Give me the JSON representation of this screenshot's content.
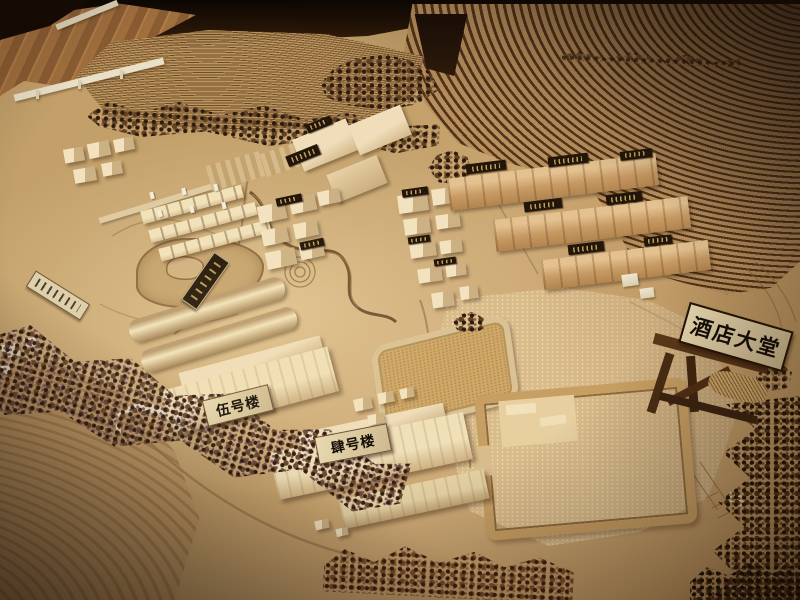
{
  "scene": {
    "type": "photograph",
    "subject": "Wooden architectural scale model of a hillside resort town",
    "setting": "indoor exhibition table under warm lighting, elevated oblique view",
    "features": [
      "laser-cut terraced contour hillsides",
      "clusters of carved wooden buildings and townhouse rows",
      "meandering stream, lake and spiral garden",
      "large plaza with hotel-lobby courtyard footprint",
      "bands of model trees along slopes and edges",
      "engraved wooden name plaques on buildings"
    ]
  },
  "signs": {
    "hotel_lobby": "酒店大堂",
    "building_no5": "伍号楼",
    "building_no4": "肆号楼"
  },
  "colors": {
    "terrain_tan": "#c9a470",
    "terrace_dark": "#53341a",
    "building_cream": "#eedcb2",
    "townhouse_clay": "#c89a64",
    "plaza_sand": "#d9bc8c",
    "sign_face": "#e2d0a6",
    "sign_text": "#140d06",
    "background_shadow": "#150b04",
    "floor_wood": "#a06f3e"
  }
}
